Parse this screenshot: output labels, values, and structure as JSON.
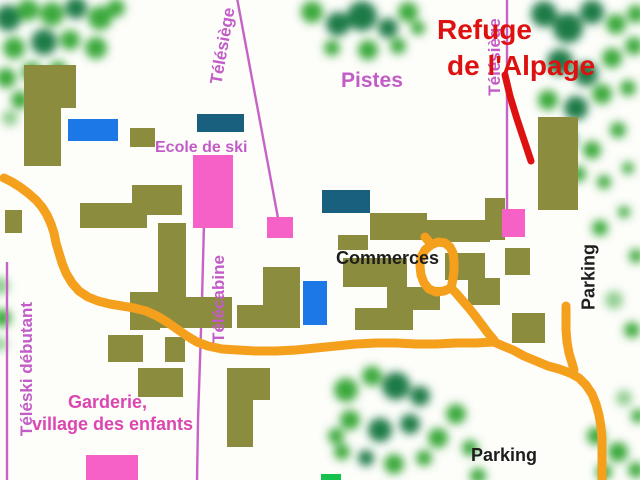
{
  "map": {
    "labels": {
      "refuge_line1": "Refuge",
      "refuge_line2": "de l'Alpage",
      "pistes": "Pistes",
      "ecole_de_ski": "Ecole de ski",
      "commerces": "Commerces",
      "garderie_line1": "Garderie,",
      "garderie_line2": "village des enfants",
      "parking_right": "Parking",
      "parking_bottom": "Parking",
      "telesiege_top": "Télésiège",
      "telesiege_right": "Télésiège",
      "telecabine": "Télécabine",
      "teleski_debutant": "Téléski débutant"
    },
    "legend_semantics": {
      "olive": "bâtiments",
      "pink": "gares de remontées / école de ski / garderie",
      "orange": "chemin piéton",
      "green": "arbres / pistes",
      "red": "repère Refuge de l'Alpage"
    }
  },
  "colors": {
    "bg": "#fdfdfa",
    "olive": "#8c8c3e",
    "blue": "#1b78e6",
    "teal": "#19607f",
    "pink": "#f561c7",
    "pink-line": "#c763c7",
    "orange": "#f4a01c",
    "red": "#de1111",
    "label-violet": "#c25cc7",
    "label-magenta": "#db46b1",
    "text-black": "#1d1d1d",
    "tree-bright": "#3aa93a",
    "tree-dark": "#1f7a46",
    "tree-light": "#8fce8f",
    "green-rect": "#16c14c"
  }
}
